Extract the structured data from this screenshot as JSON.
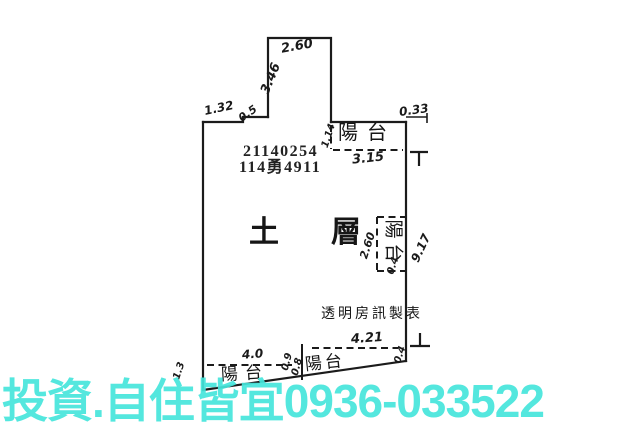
{
  "page": {
    "background": "#ffffff",
    "line_color": "#1b1b1b"
  },
  "plan": {
    "registry_number": "21140254",
    "lot_number": "114勇4911",
    "room_label": "土層",
    "maker_label": "透明房訊製表",
    "balcony_top_label": "陽台",
    "balcony_right_label": "陽台",
    "balcony_bottom_left_label": "陽台",
    "balcony_bottom_mid_label": "陽台",
    "dimensions": {
      "top_protrusion_width": "2.60",
      "top_protrusion_height": "3.46",
      "top_left_edge": "1.32",
      "top_left_step": "0.5",
      "top_right_offset": "0.33",
      "top_balcony_depth": "1.14",
      "top_balcony_width": "3.15",
      "right_wall_height": "9.17",
      "right_balcony_height": "2.60",
      "right_balcony_end": "0.4",
      "bottom_right_width": "4.21",
      "bottom_left_width": "4.0",
      "bottom_left_depth": "1.3",
      "bottom_mid_a": "0.9",
      "bottom_mid_b": "0.8",
      "bottom_right_end": "0.4"
    }
  },
  "watermark": {
    "text": "投資.自住皆宜0936-033522",
    "color": "#46e6dc"
  }
}
